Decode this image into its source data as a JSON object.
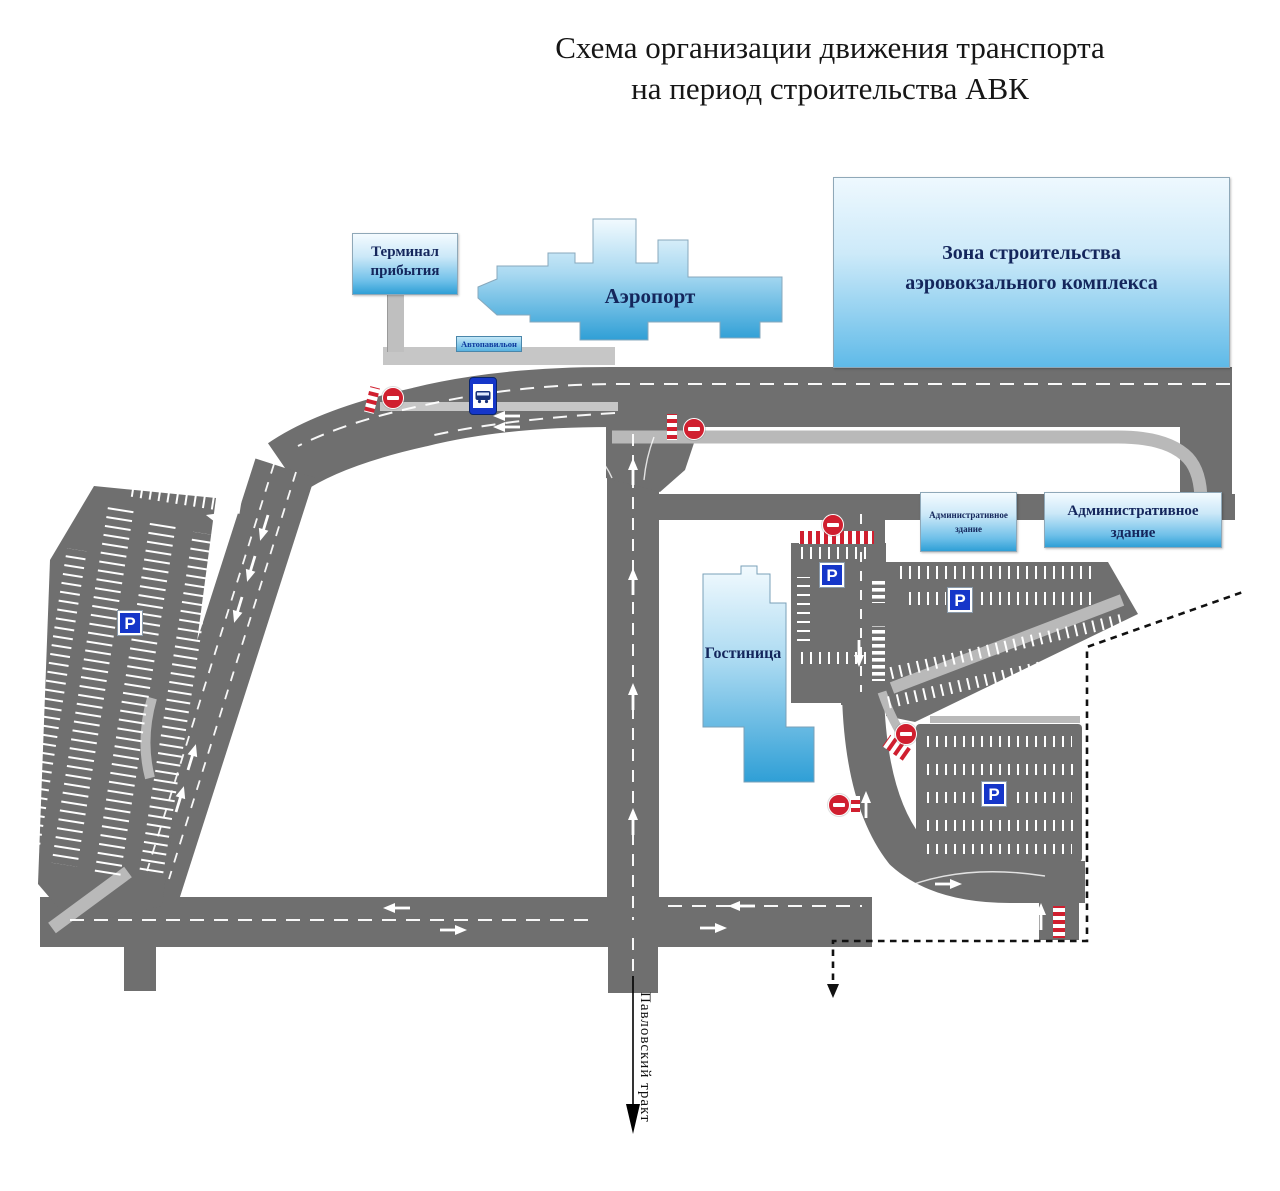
{
  "title": {
    "line1": "Схема организации движения транспорта",
    "line2": "на период строительства АВК"
  },
  "buildings": {
    "terminal_sign": "Терминал прибытия",
    "airport": "Аэропорт",
    "bus_shelter": "Автопавильон",
    "construction_zone": "Зона строительства аэровокзального комплекса",
    "admin_building_small": "Административное здание",
    "admin_building_large": "Административное здание",
    "hotel": "Гостиница"
  },
  "roads": {
    "main_road_label": "Павловский тракт"
  },
  "signs": {
    "parking_label": "P",
    "parking_sign_count": 4,
    "no_entry_sign_count": 5
  },
  "colors": {
    "road_gray": "#6f6f6f",
    "sidewalk_gray": "#b9b9b9",
    "building_blue": "#2f9fd6",
    "parking_sign_blue": "#1536c9",
    "no_entry_red": "#d01f2f",
    "label_navy": "#14265c"
  }
}
